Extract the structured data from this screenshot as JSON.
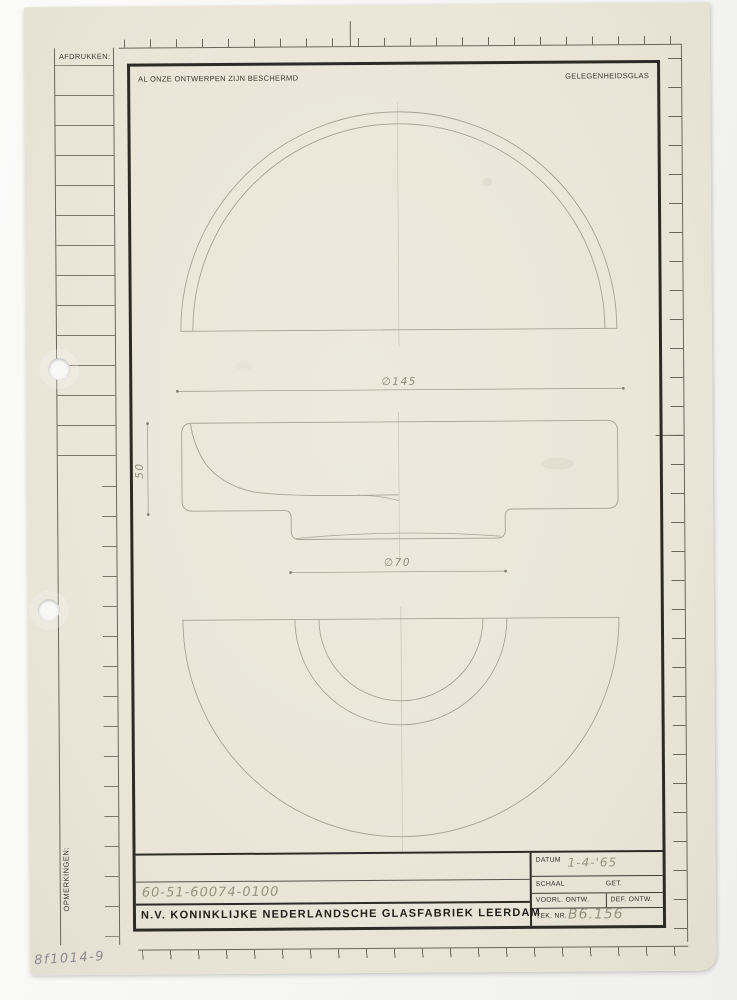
{
  "scan": {
    "corner_note": "8f1014-9"
  },
  "margin_panel": {
    "afdrukken_label": "AFDRUKKEN:",
    "opmerkingen_label": "OPMERKINGEN:"
  },
  "header": {
    "protection_notice": "AL ONZE ONTWERPEN ZIJN BESCHERMD",
    "category": "GELEGENHEIDSGLAS"
  },
  "drawing": {
    "dim_top_diameter": "∅145",
    "dim_height": "50",
    "dim_foot_diameter": "∅70"
  },
  "title_block": {
    "product_number": "60-51-60074-0100",
    "company_name": "N.V. KONINKLIJKE NEDERLANDSCHE GLASFABRIEK LEERDAM",
    "datum": {
      "label": "DATUM",
      "value": "1-4-'65"
    },
    "schaal": {
      "label": "SCHAAL"
    },
    "get": {
      "label": "GET."
    },
    "voorl_ontw": {
      "label": "VOORL. ONTW."
    },
    "def_ontw": {
      "label": "DEF. ONTW."
    },
    "tek_nr": {
      "label": "TEK. NR.",
      "value": "B6.156"
    }
  },
  "colors": {
    "paper": "#ebe8db",
    "frame_ink": "#2d2b25",
    "print_line": "#6a675c",
    "pencil": "#a7a293"
  }
}
